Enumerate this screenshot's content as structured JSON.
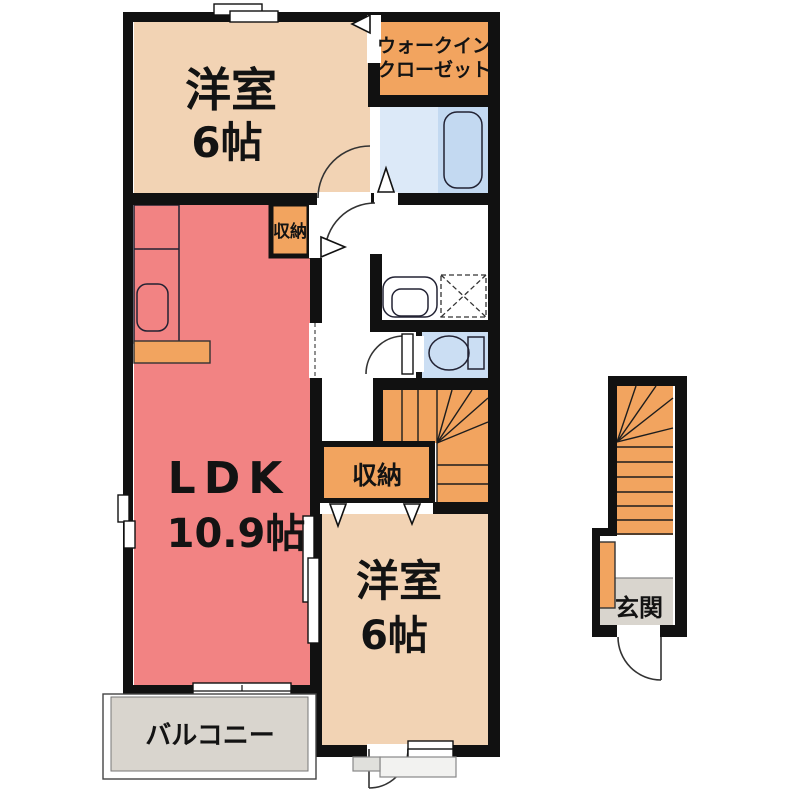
{
  "plan": {
    "colors": {
      "wall": "#111111",
      "room_tan": "#F2D3B4",
      "ldk_red": "#F28383",
      "orange": "#F2A45F",
      "counter_blue": "#C3D9F1",
      "bath_light": "#DCE9F8",
      "fixture_cyan": "#B5EBF0",
      "toilet_blue": "#CBDEF3",
      "gray_floor": "#D9D5CE"
    },
    "labels": {
      "bedroom1_name": "洋室",
      "bedroom1_size": "6帖",
      "wic_line1": "ウォークイン",
      "wic_line2": "クローゼット",
      "hall_storage": "収納",
      "ldk_name": "LDK",
      "ldk_size": "10.9帖",
      "bedroom2_storage": "収納",
      "bedroom2_name": "洋室",
      "bedroom2_size": "6帖",
      "balcony": "バルコニー",
      "entrance": "玄関"
    }
  }
}
